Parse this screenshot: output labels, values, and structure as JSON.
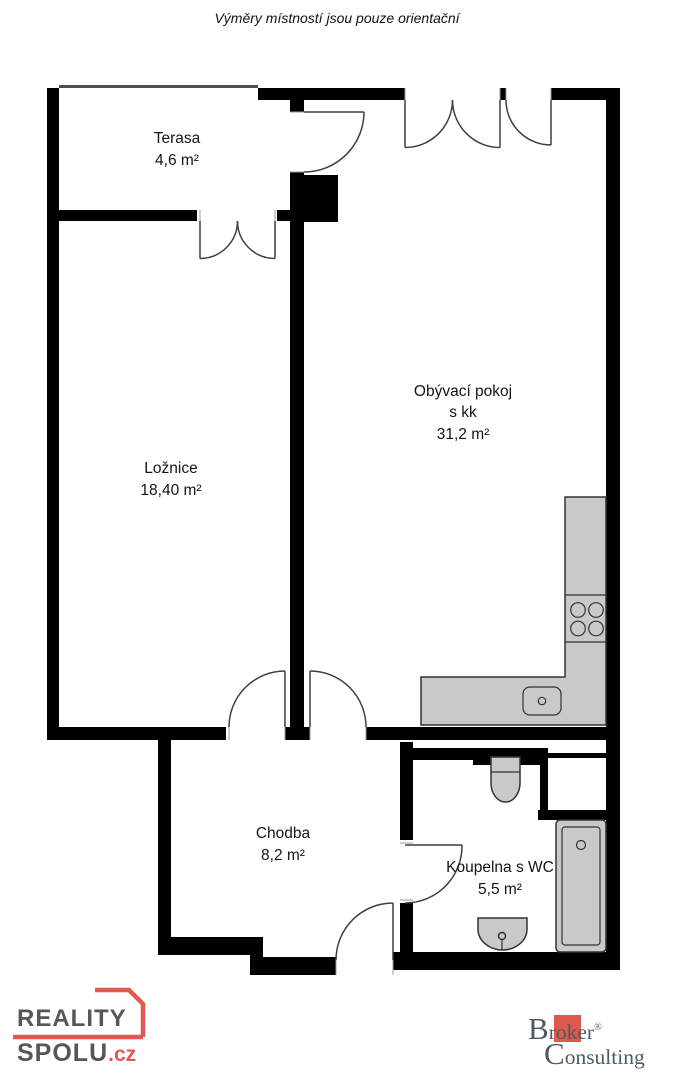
{
  "disclaimer": "Výměry místností jsou pouze orientační",
  "rooms": {
    "terasa": {
      "name": "Terasa",
      "area": "4,6 m²"
    },
    "loznice": {
      "name": "Ložnice",
      "area": "18,40 m²"
    },
    "obyvaci_pokoj": {
      "name": "Obývací pokoj",
      "subtitle": "s kk",
      "area": "31,2 m²"
    },
    "chodba": {
      "name": "Chodba",
      "area": "8,2 m²"
    },
    "koupelna": {
      "name": "Koupelna s WC",
      "area": "5,5 m²"
    }
  },
  "fixtures": {
    "kitchen_counter": "kitchen-counter",
    "stove": "stove-burners-icon",
    "kitchen_sink": "kitchen-sink-icon",
    "toilet": "toilet-icon",
    "bathtub": "bathtub-icon",
    "washbasin": "washbasin-icon"
  },
  "branding": {
    "reality_spolu": {
      "line1": "REALITY",
      "line2": "SPOLU",
      "tld": ".cz",
      "text_color": "#57575a",
      "accent_color": "#e2584e"
    },
    "broker_consulting": {
      "cap1": "B",
      "rest1": "roker",
      "registered": "®",
      "cap2": "C",
      "rest2": "onsulting",
      "text_color": "#4e5a64",
      "accent_color": "#df5850"
    }
  },
  "colors": {
    "wall": "#000000",
    "fixture_fill": "#c9c9c9",
    "background": "#ffffff"
  }
}
